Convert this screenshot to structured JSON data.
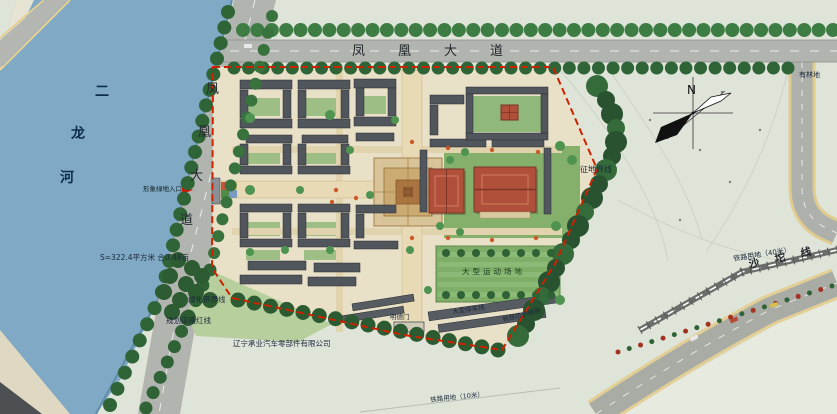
{
  "map": {
    "roads": {
      "top_label": "凤凰大道",
      "left_chars": [
        "凤",
        "凰",
        "大",
        "道"
      ]
    },
    "river": {
      "chars": [
        "二",
        "龙",
        "河"
      ]
    },
    "compass": {
      "label": "N"
    },
    "annotations": {
      "land_acquisition_boundary": "征地界线",
      "railway_land_40": "铁路用地（40米）",
      "railway_name": "沙坨线",
      "wooded_land": "有林地",
      "area_note": "S=322.4平方米 合0.48亩",
      "green_belt_boundary": "绿化带界线",
      "planned_road_redline": "规划道路红线",
      "company_name": "辽宁承业汽车零部件有限公司",
      "main_entrance": "形象绿地入口",
      "sports_field": "大型运动场地",
      "parking_lot": "大型停车场",
      "railway_green_belt": "铁路防护绿带",
      "south_gate": "明德门",
      "railway_land_10": "铁路用地（10米）"
    },
    "colors": {
      "river": "#7fa9c4",
      "road": "#b2b4b0",
      "compound_ground": "#e9e0c8",
      "open_land": "#dfe4d9",
      "tree_dark": "#2c5a31",
      "tree_light": "#4f9351",
      "lawn": "#85b06c",
      "red_roof": "#b0503a",
      "boundary_red": "#cc2200",
      "building": "#50565c"
    }
  }
}
